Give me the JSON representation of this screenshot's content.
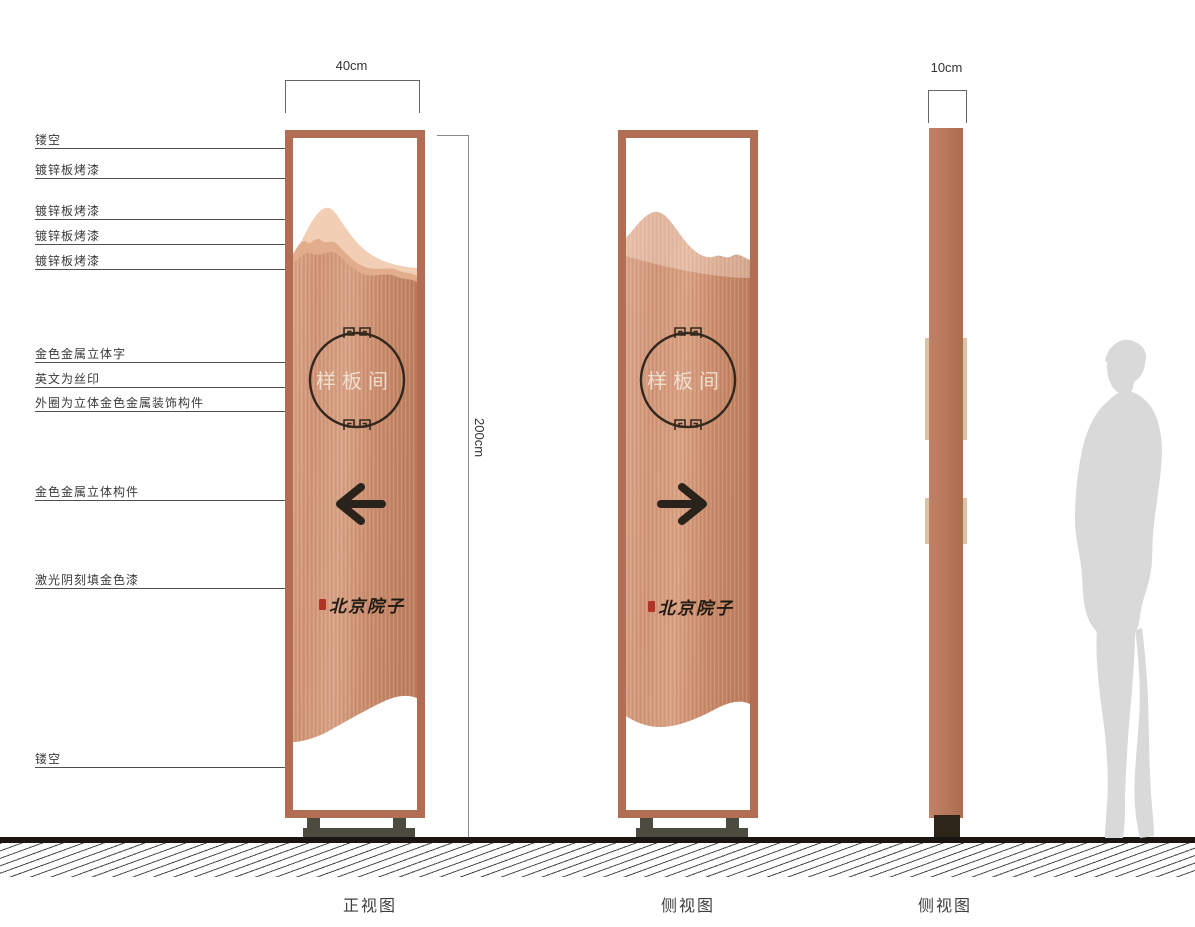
{
  "callouts": [
    {
      "label": "镂空"
    },
    {
      "label": "镀锌板烤漆"
    },
    {
      "label": "镀锌板烤漆"
    },
    {
      "label": "镀锌板烤漆"
    },
    {
      "label": "镀锌板烤漆"
    },
    {
      "label": "金色金属立体字"
    },
    {
      "label": "英文为丝印"
    },
    {
      "label": "外圈为立体金色金属装饰构件"
    },
    {
      "label": "金色金属立体构件"
    },
    {
      "label": "激光阴刻填金色漆"
    },
    {
      "label": "镂空"
    }
  ],
  "dimensions": {
    "front_width": "40cm",
    "side_width": "10cm",
    "height": "200cm"
  },
  "views": [
    {
      "label": "正视图"
    },
    {
      "label": "侧视图"
    },
    {
      "label": "侧视图"
    }
  ],
  "sign": {
    "room_label": "样板间",
    "brand": "北京院子"
  },
  "icons": {
    "front_arrow": "arrow-left",
    "side_arrow": "arrow-right",
    "emblem_ornament": "meander-pattern",
    "seal": "red-seal-stamp"
  },
  "colors": {
    "frame": "#b26e53",
    "panel_base": "#cf9377",
    "panel_light": "#f2cfb4",
    "panel_mid": "#e2ad8d",
    "arrow": "#2a231c",
    "base": "#4c4b40",
    "ground": "#191512",
    "silhouette": "#d9d9d9",
    "seal_red": "#b13527"
  }
}
